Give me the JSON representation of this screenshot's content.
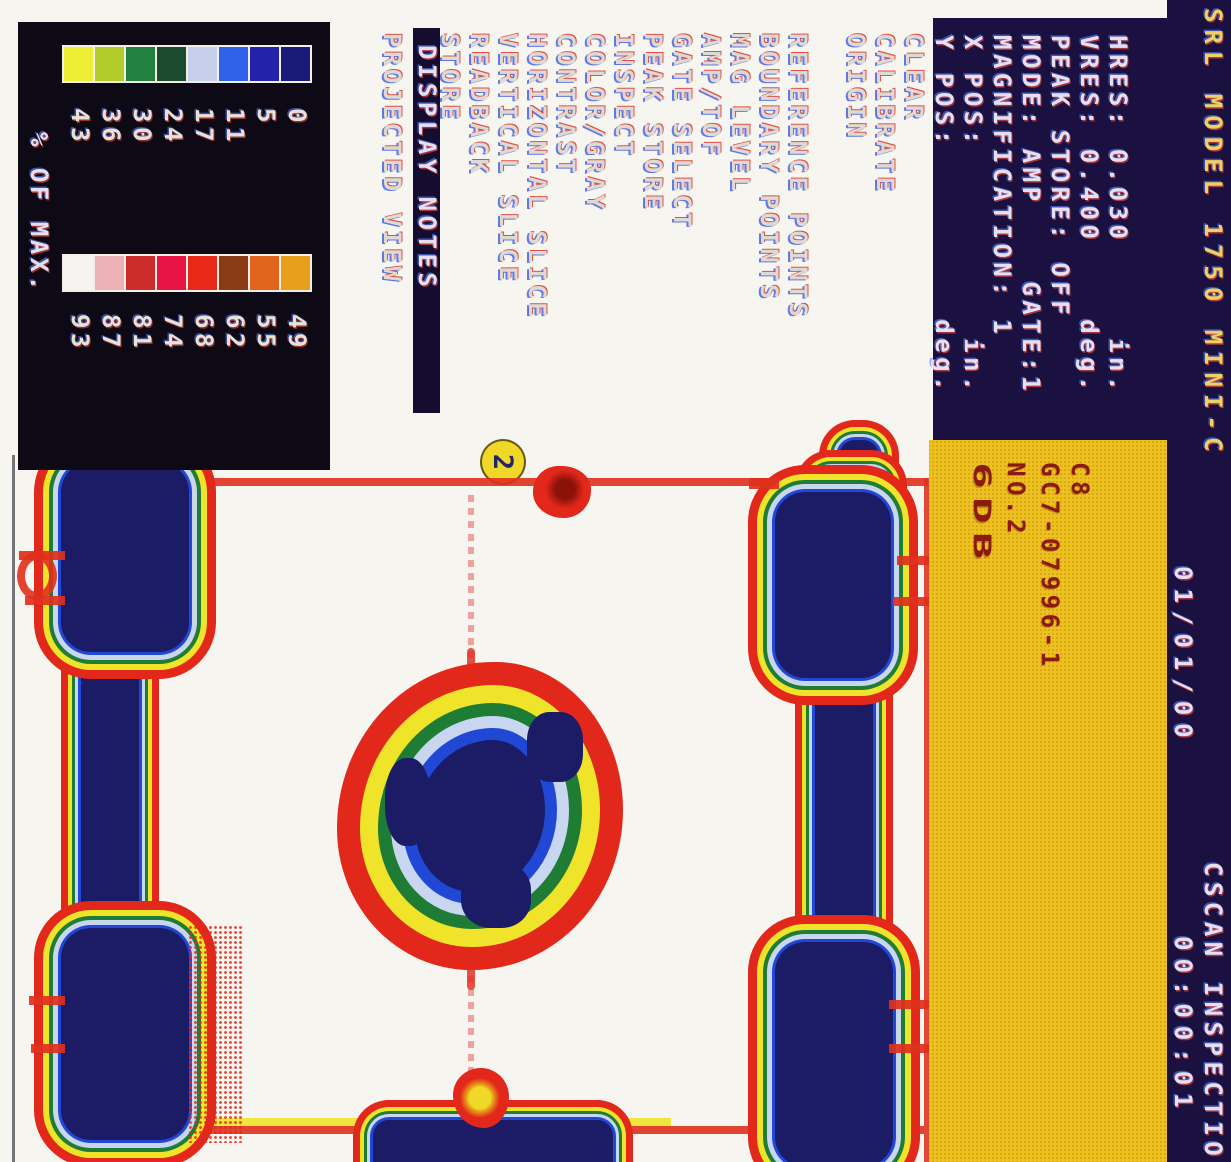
{
  "header": {
    "system_title": "SRL MODEL 1750 MINI-C",
    "screen_title": "CSCAN INSPECTIO",
    "date": "01/01/00",
    "time": "00:00:01"
  },
  "parameters": {
    "lines": [
      "HRES: 0.030     in.",
      "VRES: 0.400    deg.",
      "PEAK STORE: OFF",
      "MODE: AMP    GATE:1",
      "MAGNIFICATION: 1",
      "X POS:          in.",
      "Y POS:         deg."
    ]
  },
  "note_panel": {
    "line1": "C8",
    "line2": "GC7-07996-1",
    "line3": "NO.2",
    "line4": "6DB"
  },
  "menu": {
    "items": [
      {
        "label": "CLEAR",
        "highlighted": false
      },
      {
        "label": "CALIBRATE",
        "highlighted": false
      },
      {
        "label": "ORIGIN",
        "highlighted": false
      },
      {
        "label": "REFERENCE POINTS",
        "highlighted": false
      },
      {
        "label": "BOUNDARY POINTS",
        "highlighted": false
      },
      {
        "label": "MAG LEVEL",
        "highlighted": false
      },
      {
        "label": "AMP/TOF",
        "highlighted": false
      },
      {
        "label": "GATE SELECT",
        "highlighted": false
      },
      {
        "label": "PEAK STORE",
        "highlighted": false
      },
      {
        "label": "INSPECT",
        "highlighted": false
      },
      {
        "label": "COLOR/GRAY",
        "highlighted": false
      },
      {
        "label": "CONTRAST",
        "highlighted": false
      },
      {
        "label": "HORIZONTAL SLICE",
        "highlighted": false
      },
      {
        "label": "VERTICAL SLICE",
        "highlighted": false
      },
      {
        "label": "READBACK",
        "highlighted": false
      },
      {
        "label": "STORE",
        "highlighted": false
      },
      {
        "label": "DISPLAY NOTES",
        "highlighted": true
      },
      {
        "label": "PROJECTED VIEW",
        "highlighted": false
      }
    ]
  },
  "color_scale": {
    "caption": "% OF MAX.",
    "left": {
      "values": [
        0,
        5,
        11,
        17,
        24,
        30,
        36,
        43
      ],
      "colors": [
        "#1a1a78",
        "#2222aa",
        "#2f62e8",
        "#c6d0ec",
        "#1c4a2e",
        "#20823e",
        "#b2cc2a",
        "#eeee34"
      ]
    },
    "right": {
      "values": [
        49,
        55,
        62,
        68,
        74,
        81,
        87,
        93
      ],
      "colors": [
        "#e8a01c",
        "#e0641c",
        "#8a3a14",
        "#e82818",
        "#e81444",
        "#cc2c2c",
        "#eeb2b6",
        "#f6f4f0"
      ]
    }
  },
  "annotation": {
    "label": "2"
  },
  "colors": {
    "screen_background": "#f7f5ef",
    "panel_navy": "#1a1140",
    "note_panel_yellow": "#edc21f",
    "note_text_maroon": "#8c1a10",
    "title_yellow": "#e9d463",
    "defect_navy": "#1b1b66",
    "indication_red": "#e2271b",
    "fringe_yellow": "#efe42a",
    "fringe_green": "#1f7c35",
    "fringe_blue": "#2148d4"
  }
}
